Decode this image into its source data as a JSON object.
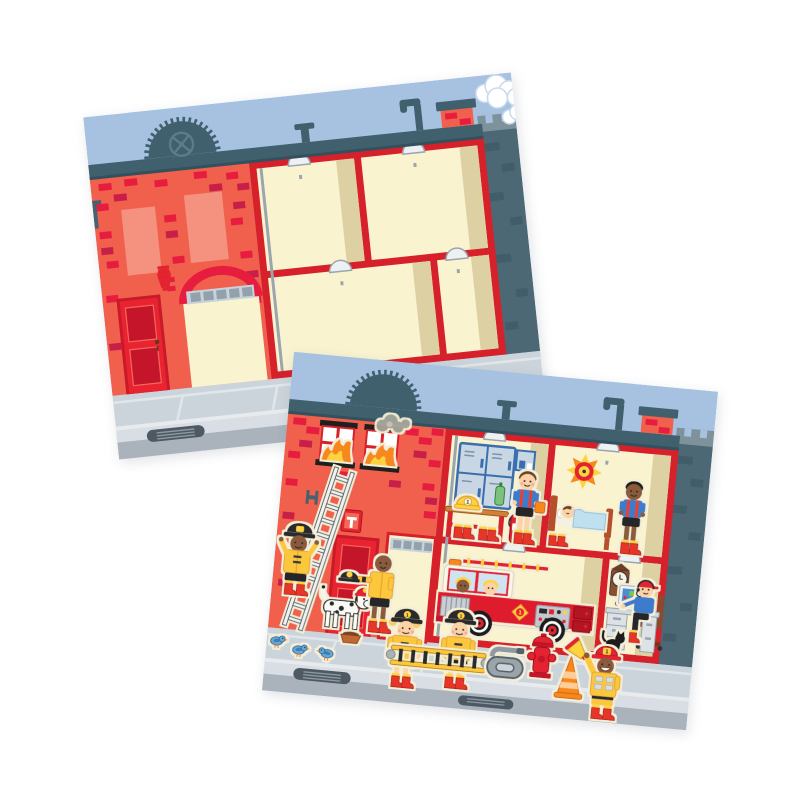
{
  "image": {
    "kind": "product illustration",
    "description": "Two overlapping tilted fire-station sticker-scene cards on a white background; the rear card shows the empty fire station scene, the front card shows the same scene decorated with firefighter stickers"
  },
  "badge_number": "1",
  "palette": {
    "sky": "#a7c1e1",
    "building": "#f1604c",
    "brick": "#e71d40",
    "brick_dark": "#c81f48",
    "salmon": "#f5917f",
    "frame": "#d6212b",
    "cream": "#faf3d0",
    "tan": "#ddd1a4",
    "slate": "#41606e",
    "wall": "#4c6875",
    "wall_brick": "#415d6a",
    "walk": "#ccd4db",
    "curb": "#d9dee4",
    "road": "#aab3bc",
    "drain": "#4d5963",
    "sticker": "#f3eed7",
    "gear_yellow": "#fcc73e",
    "gear_yellow_dark": "#e7a42a",
    "red": "#e32330",
    "dark_red": "#c5152b",
    "blue": "#3e7ccc",
    "skin_light": "#fcd2a6",
    "skin_dark": "#8a5a3a",
    "flame_orange": "#f6881f",
    "flame_yellow": "#ffd23f",
    "smoke": "#a6a69b"
  },
  "back_card": {
    "name": "empty fire station scene page",
    "rotation_deg": -6,
    "aria_label": "Empty fire station scene card: blue sky, clouds, red brick firehouse with arched garage door, red entry door, lantern, four empty cream rooms in a red frame, fire pole, ceiling lamps, dark neighbor wall, gray sidewalk with storm drain",
    "elements": [
      "blue sky",
      "white clouds",
      "dark roofline with scalloped fire-department emblem",
      "vent pipes and brick chimney",
      "red brick facade",
      "salmon window patches",
      "red entry door",
      "red wall lantern",
      "arched garage opening with gray transom windows",
      "four empty cream rooms",
      "fire pole",
      "ceiling lamps",
      "dark neighbor building wall",
      "gray sidewalk, curb and storm drain"
    ]
  },
  "front_card": {
    "name": "fire station scene page with stickers applied",
    "rotation_deg": 5.4,
    "aria_label": "Fire station scene card decorated with stickers: burning windows, locker room, bedroom, garage with fire engine, dispatch office, and firefighters, dalmatian, hydrant, cone and more on the sidewalk",
    "rooms": [
      "burning upstairs windows",
      "locker room",
      "bedroom",
      "garage",
      "dispatch office"
    ],
    "stickers": [
      "flames in windows",
      "smoke puff",
      "white ladder leaning on wall",
      "firefighter climbing ladder",
      "dalmatian wearing fire helmet",
      "firefighter offering black helmet",
      "fire helmet on bench",
      "fire extinguisher",
      "firefighter in blue t-shirt with suspenders",
      "fire-alarm bell",
      "sleeping firefighter in bed",
      "firefighter in blue t-shirt in bedroom",
      "fire engine with two crew",
      "cuckoo clock",
      "dispatcher at computer desk",
      "black cat",
      "three blue birds",
      "dog food bowl",
      "two firefighters carrying yellow ladder",
      "coiled fire hose",
      "red fire hydrant",
      "orange traffic cone",
      "firefighter with megaphone"
    ]
  }
}
